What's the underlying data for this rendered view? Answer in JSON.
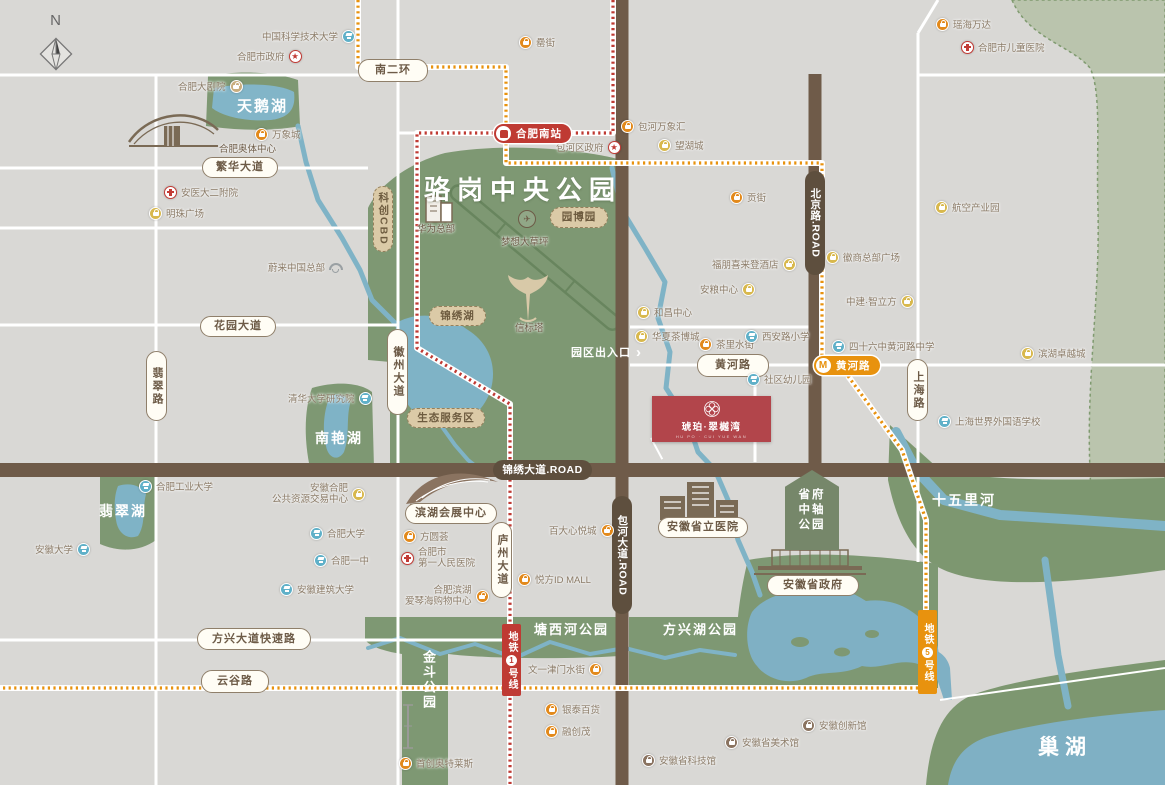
{
  "meta": {
    "type": "real-estate-location-map",
    "city_lake": "巢湖"
  },
  "colors": {
    "background": "#d9d8d5",
    "park_green": "#7e9873",
    "pale_green": "#bac4ad",
    "water": "#7fb3c6",
    "road_brown": "#6f5b49",
    "metro_line1_red": "#bf3a33",
    "metro_line5_orange": "#e8920e",
    "project_red": "#b2454b",
    "pill_cream": "#fffdf5"
  },
  "compass": {
    "label": "N"
  },
  "project": {
    "name": "琥珀·翠樾湾",
    "subtitle": "HU PO · CUI YUE WAN"
  },
  "gate": {
    "label": "园区出入口"
  },
  "pentagon": {
    "lines": [
      "省府",
      "中轴",
      "公园"
    ]
  },
  "metro": {
    "line1": {
      "prefix": "地铁",
      "num": "1",
      "suffix": "号线",
      "station": "合肥南站"
    },
    "line5": {
      "prefix": "地铁",
      "num": "5",
      "suffix": "号线",
      "station": "黄河路"
    }
  },
  "area_labels": [
    {
      "name": "luogang-park-title",
      "label": "骆岗中央公园",
      "type": "park-title",
      "x": 424,
      "y": 170
    },
    {
      "name": "swan-lake-label",
      "label": "天鹅湖",
      "x": 237,
      "y": 95,
      "size": 15
    },
    {
      "name": "nanyan-lake-label",
      "label": "南艳湖",
      "x": 315,
      "y": 428,
      "size": 14
    },
    {
      "name": "feicui-lake-label",
      "label": "翡翠湖",
      "x": 99,
      "y": 501,
      "size": 14
    },
    {
      "name": "jindou-park-label",
      "label": "金斗公园",
      "x": 419,
      "y": 650,
      "size": 13,
      "vertical": true
    },
    {
      "name": "tangxihe-park-label",
      "label": "塘西河公园",
      "x": 534,
      "y": 619,
      "size": 13
    },
    {
      "name": "fangxinghu-park-label",
      "label": "方兴湖公园",
      "x": 663,
      "y": 619,
      "size": 13
    },
    {
      "name": "shiwuli-river-label",
      "label": "十五里河",
      "x": 932,
      "y": 490,
      "size": 14
    },
    {
      "name": "chaohu-lake-label",
      "label": "巢湖",
      "type": "chaohu",
      "x": 1038,
      "y": 731,
      "size": 21
    },
    {
      "name": "olympic-center-label",
      "label": "合肥奥体中心",
      "type": "brown",
      "x": 219,
      "y": 141
    },
    {
      "name": "huawei-hq-label",
      "label": "华为总部",
      "type": "brown",
      "x": 417,
      "y": 221
    },
    {
      "name": "dream-lawn-label",
      "label": "梦想大草坪",
      "type": "brown",
      "x": 501,
      "y": 234
    },
    {
      "name": "beacon-tower-label",
      "label": "信标塔",
      "type": "brown",
      "x": 515,
      "y": 320
    }
  ],
  "road_pills": [
    {
      "name": "road-nanerhuan",
      "label": "南二环",
      "x": 358,
      "y": 59,
      "w": 70,
      "h": 23
    },
    {
      "name": "road-fanhua-ave",
      "label": "繁华大道",
      "x": 202,
      "y": 157,
      "w": 76,
      "h": 21
    },
    {
      "name": "road-huayuan-ave",
      "label": "花园大道",
      "x": 200,
      "y": 316,
      "w": 76,
      "h": 21
    },
    {
      "name": "road-fangxing-expwy",
      "label": "方兴大道快速路",
      "x": 197,
      "y": 628,
      "w": 114,
      "h": 22
    },
    {
      "name": "road-yungu",
      "label": "云谷路",
      "x": 201,
      "y": 670,
      "w": 68,
      "h": 23
    },
    {
      "name": "road-huanghe",
      "label": "黄河路",
      "x": 697,
      "y": 354,
      "w": 72,
      "h": 23
    },
    {
      "name": "road-feicui",
      "label": "翡翠路",
      "vertical": true,
      "x": 146,
      "y": 351,
      "w": 21,
      "h": 70
    },
    {
      "name": "road-huizhou-ave",
      "label": "徽州大道",
      "vertical": true,
      "x": 387,
      "y": 329,
      "w": 21,
      "h": 86
    },
    {
      "name": "road-luzhou-ave",
      "label": "庐州大道",
      "vertical": true,
      "x": 491,
      "y": 522,
      "w": 21,
      "h": 76
    },
    {
      "name": "road-shanghai",
      "label": "上海路",
      "vertical": true,
      "x": 907,
      "y": 359,
      "w": 21,
      "h": 62
    },
    {
      "name": "road-jinxiu-ave",
      "label": "锦绣大道.ROAD",
      "type": "dark",
      "x": 493,
      "y": 460,
      "w": 99,
      "h": 20
    },
    {
      "name": "road-beijing",
      "label": "北京路.ROAD",
      "type": "dark",
      "vertical": true,
      "x": 805,
      "y": 171,
      "w": 20,
      "h": 104
    },
    {
      "name": "road-baohe-ave",
      "label": "包河大道.ROAD",
      "type": "dark",
      "vertical": true,
      "x": 612,
      "y": 496,
      "w": 20,
      "h": 118
    },
    {
      "name": "zone-kechuang-cbd",
      "label": "科创CBD",
      "type": "tan",
      "vertical": true,
      "x": 373,
      "y": 186,
      "w": 20,
      "h": 66
    },
    {
      "name": "zone-jinxiu-lake",
      "label": "锦绣湖",
      "type": "tan",
      "x": 429,
      "y": 306,
      "w": 57,
      "h": 20
    },
    {
      "name": "zone-eco-service",
      "label": "生态服务区",
      "type": "tan",
      "x": 407,
      "y": 408,
      "w": 78,
      "h": 20
    },
    {
      "name": "zone-yuanboyuan",
      "label": "园博园",
      "type": "tan",
      "x": 550,
      "y": 207,
      "w": 58,
      "h": 21
    },
    {
      "name": "binhu-convention-label",
      "label": "滨湖会展中心",
      "type": "land",
      "x": 405,
      "y": 503,
      "w": 92,
      "h": 21
    },
    {
      "name": "anhui-provincial-hospital-label",
      "label": "安徽省立医院",
      "type": "land",
      "x": 658,
      "y": 517,
      "w": 90,
      "h": 21
    },
    {
      "name": "anhui-gov-label",
      "label": "安徽省政府",
      "type": "land",
      "x": 767,
      "y": 575,
      "w": 92,
      "h": 21
    }
  ],
  "pois": [
    {
      "name": "poi-ustc",
      "label": "中国科学技术大学",
      "type": "school",
      "side": "right",
      "x": 262,
      "y": 29
    },
    {
      "name": "poi-hefei-city-gov",
      "label": "合肥市政府",
      "type": "gov",
      "side": "right",
      "x": 237,
      "y": 49
    },
    {
      "name": "poi-grand-theatre",
      "label": "合肥大剧院",
      "type": "theater",
      "side": "right",
      "x": 178,
      "y": 79
    },
    {
      "name": "poi-mixc",
      "label": "万象城",
      "type": "shop",
      "x": 255,
      "y": 127
    },
    {
      "name": "poi-anyida-2nd-hospital",
      "label": "安医大二附院",
      "type": "hospital",
      "x": 164,
      "y": 185
    },
    {
      "name": "poi-mingzhu-plaza",
      "label": "明珠广场",
      "type": "mall",
      "x": 149,
      "y": 206
    },
    {
      "name": "poi-nio-hq",
      "label": "蔚来中国总部",
      "type": "nio",
      "side": "right",
      "x": 268,
      "y": 260
    },
    {
      "name": "poi-tsinghua-institute",
      "label": "清华大学研究院",
      "type": "school",
      "side": "right",
      "x": 288,
      "y": 391
    },
    {
      "name": "poi-lei-street",
      "label": "罍街",
      "type": "shop",
      "x": 519,
      "y": 35
    },
    {
      "name": "poi-yaohai-wanda",
      "label": "瑶海万达",
      "type": "shop",
      "x": 936,
      "y": 17
    },
    {
      "name": "poi-children-hospital",
      "label": "合肥市儿童医院",
      "type": "hospital",
      "x": 961,
      "y": 40
    },
    {
      "name": "poi-aviation-park",
      "label": "航空产业园",
      "type": "mall",
      "x": 935,
      "y": 200
    },
    {
      "name": "poi-gong-street",
      "label": "贡街",
      "type": "shop",
      "x": 730,
      "y": 190
    },
    {
      "name": "poi-baohe-mixc",
      "label": "包河万象汇",
      "type": "shop",
      "x": 621,
      "y": 119
    },
    {
      "name": "poi-wanghucheng",
      "label": "望湖城",
      "type": "mall",
      "x": 658,
      "y": 138
    },
    {
      "name": "poi-baohe-district-gov",
      "label": "包河区政府",
      "type": "gov",
      "side": "right",
      "x": 556,
      "y": 140
    },
    {
      "name": "poi-four-points-hotel",
      "label": "福朋喜来登酒店",
      "type": "mall",
      "side": "right",
      "x": 712,
      "y": 257
    },
    {
      "name": "poi-anliang-center",
      "label": "安粮中心",
      "type": "mall",
      "side": "right",
      "x": 700,
      "y": 282
    },
    {
      "name": "poi-hechang-center",
      "label": "和昌中心",
      "type": "mall",
      "x": 637,
      "y": 305
    },
    {
      "name": "poi-huaxia-tea-city",
      "label": "华夏茶博城",
      "type": "mall",
      "x": 635,
      "y": 329
    },
    {
      "name": "poi-chali-water-street",
      "label": "茶里水街",
      "type": "shop",
      "x": 699,
      "y": 337
    },
    {
      "name": "poi-xianlu-primary",
      "label": "西安路小学",
      "type": "school",
      "x": 745,
      "y": 329
    },
    {
      "name": "poi-community-kindergarten",
      "label": "社区幼儿园",
      "type": "school",
      "x": 747,
      "y": 372
    },
    {
      "name": "poi-huishang-hq-plaza",
      "label": "徽商总部广场",
      "type": "mall",
      "x": 826,
      "y": 250
    },
    {
      "name": "poi-zhongjian-zhilifang",
      "label": "中建·智立方",
      "type": "mall",
      "side": "right",
      "x": 846,
      "y": 294
    },
    {
      "name": "poi-no46-huanghe-school",
      "label": "四十六中黄河路中学",
      "type": "school",
      "x": 832,
      "y": 339
    },
    {
      "name": "poi-binhu-zhuoyue-city",
      "label": "滨湖卓越城",
      "type": "mall",
      "x": 1021,
      "y": 346
    },
    {
      "name": "poi-shanghai-foreign-school",
      "label": "上海世界外国语学校",
      "type": "school",
      "x": 938,
      "y": 414
    },
    {
      "name": "poi-public-resource-center",
      "label": [
        "安徽合肥",
        "公共资源交易中心"
      ],
      "type": "mall",
      "side": "right",
      "x": 272,
      "y": 483
    },
    {
      "name": "poi-hfut",
      "label": "合肥工业大学",
      "type": "school",
      "x": 139,
      "y": 479
    },
    {
      "name": "poi-anhui-university",
      "label": "安徽大学",
      "type": "school",
      "side": "right",
      "x": 35,
      "y": 542
    },
    {
      "name": "poi-hefei-university",
      "label": "合肥大学",
      "type": "school",
      "x": 310,
      "y": 526
    },
    {
      "name": "poi-hefei-no1-school",
      "label": "合肥一中",
      "type": "school",
      "x": 314,
      "y": 553
    },
    {
      "name": "poi-anhui-jianzhu-university",
      "label": "安徽建筑大学",
      "type": "school",
      "x": 280,
      "y": 582
    },
    {
      "name": "poi-fangyuanhui",
      "label": "方圆荟",
      "type": "shop",
      "x": 403,
      "y": 529
    },
    {
      "name": "poi-first-people-hospital",
      "label": [
        "合肥市",
        "第一人民医院"
      ],
      "type": "hospital",
      "x": 401,
      "y": 547
    },
    {
      "name": "poi-aegean-mall",
      "label": [
        "合肥滨湖",
        "爱琴海购物中心"
      ],
      "type": "shop",
      "side": "right",
      "x": 405,
      "y": 585
    },
    {
      "name": "poi-yuefang-id-mall",
      "label": "悦方ID MALL",
      "type": "shop",
      "x": 518,
      "y": 572
    },
    {
      "name": "poi-baida-xinyuecheng",
      "label": "百大心悦城",
      "type": "shop",
      "side": "right",
      "x": 549,
      "y": 523
    },
    {
      "name": "poi-wenyi-jinmen-street",
      "label": "文一津门水街",
      "type": "shop",
      "side": "right",
      "x": 528,
      "y": 662
    },
    {
      "name": "poi-intime",
      "label": "银泰百货",
      "type": "shop",
      "x": 545,
      "y": 702
    },
    {
      "name": "poi-sunac-mall",
      "label": "融创茂",
      "type": "shop",
      "x": 545,
      "y": 724
    },
    {
      "name": "poi-shouchuang-outlets",
      "label": "首创奥特莱斯",
      "type": "shop",
      "x": 399,
      "y": 756
    },
    {
      "name": "poi-anhui-science-museum",
      "label": "安徽省科技馆",
      "type": "museum",
      "x": 642,
      "y": 753
    },
    {
      "name": "poi-anhui-art-museum",
      "label": "安徽省美术馆",
      "type": "museum",
      "x": 725,
      "y": 735
    },
    {
      "name": "poi-anhui-innovation-hall",
      "label": "安徽创新馆",
      "type": "museum",
      "x": 802,
      "y": 718
    }
  ]
}
